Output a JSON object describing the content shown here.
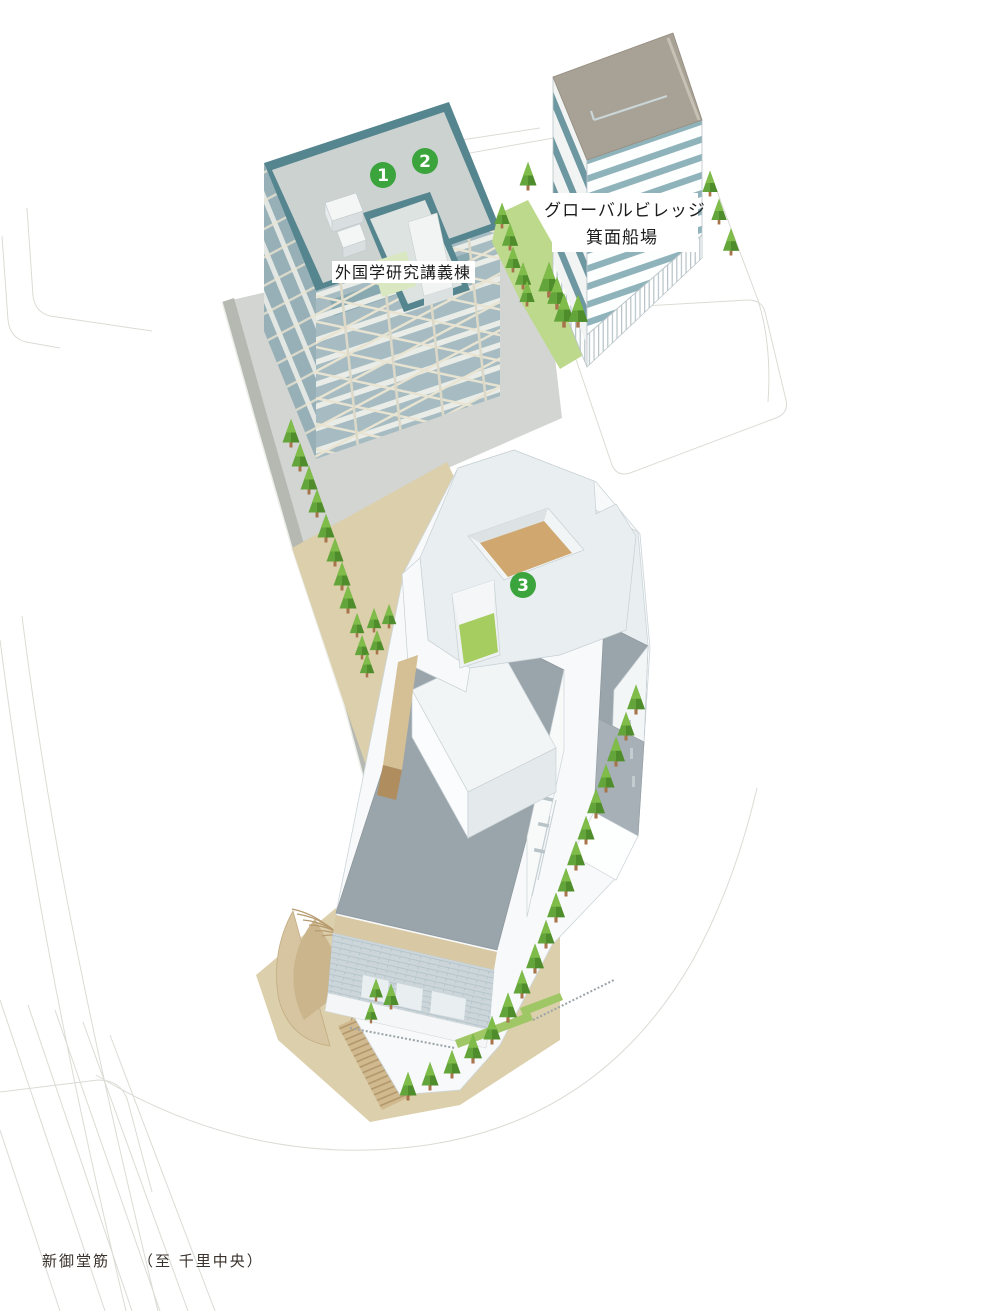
{
  "map_title": "campus site map",
  "labels": {
    "building_1": "外国学研究講義棟",
    "building_2_line1": "グローバルビレッジ",
    "building_2_line2": "箕面船場",
    "road": "新御堂筋",
    "road_direction": "（至 千里中央）"
  },
  "markers": [
    {
      "number": "1",
      "x": 383,
      "y": 175
    },
    {
      "number": "2",
      "x": 425,
      "y": 161
    },
    {
      "number": "3",
      "x": 523,
      "y": 585
    }
  ],
  "colors": {
    "marker_green": "#3ba43c",
    "tree_green": "#63a53a",
    "tree_shade": "#4f8c2b",
    "lawn_green": "#bdd98b",
    "accent_green": "#a6cd60",
    "roof_teal": "#55858e",
    "tower_band_dark": "#6d97a1",
    "tower_band_light": "#8fb3bb",
    "tower_roof_taupe": "#a8a195",
    "plaza_gray": "#d2d5d2",
    "sand_tan": "#dccfab",
    "complex_roof_gray": "#9aa5ab",
    "courtyard_tan": "#cfa76f",
    "road_line": "#dbdbd5"
  },
  "vegetation": {
    "trees": [
      [
        291,
        447,
        1.0
      ],
      [
        300,
        471,
        1.0
      ],
      [
        309,
        494,
        1.0
      ],
      [
        317,
        517,
        1.0
      ],
      [
        326,
        542,
        1.0
      ],
      [
        335,
        566,
        1.0
      ],
      [
        342,
        590,
        1.0
      ],
      [
        348,
        613,
        1.0
      ],
      [
        357,
        637,
        0.85
      ],
      [
        374,
        632,
        0.85
      ],
      [
        389,
        628,
        0.85
      ],
      [
        362,
        659,
        0.85
      ],
      [
        377,
        654,
        0.85
      ],
      [
        367,
        677,
        0.85
      ],
      [
        636,
        714,
        1.05
      ],
      [
        626,
        740,
        1.0
      ],
      [
        616,
        766,
        1.05
      ],
      [
        606,
        792,
        1.0
      ],
      [
        596,
        818,
        1.05
      ],
      [
        586,
        844,
        1.0
      ],
      [
        576,
        870,
        1.05
      ],
      [
        566,
        896,
        1.0
      ],
      [
        556,
        922,
        1.05
      ],
      [
        546,
        948,
        1.0
      ],
      [
        535,
        973,
        1.05
      ],
      [
        522,
        998,
        1.0
      ],
      [
        508,
        1022,
        1.05
      ],
      [
        492,
        1044,
        1.0
      ],
      [
        473,
        1063,
        1.05
      ],
      [
        452,
        1078,
        1.0
      ],
      [
        430,
        1090,
        1.0
      ],
      [
        408,
        1100,
        1.0
      ],
      [
        710,
        196,
        0.9
      ],
      [
        719,
        224,
        0.9
      ],
      [
        731,
        255,
        0.95
      ],
      [
        528,
        190,
        1.0
      ],
      [
        502,
        228,
        0.9
      ],
      [
        510,
        250,
        0.95
      ],
      [
        513,
        272,
        0.9
      ],
      [
        523,
        289,
        0.95
      ],
      [
        527,
        306,
        0.9
      ],
      [
        549,
        297,
        1.25
      ],
      [
        557,
        309,
        1.15
      ],
      [
        564,
        327,
        1.2
      ],
      [
        578,
        327,
        1.15
      ],
      [
        376,
        1001,
        0.8
      ],
      [
        391,
        1009,
        0.9
      ],
      [
        371,
        1023,
        0.75
      ]
    ]
  }
}
